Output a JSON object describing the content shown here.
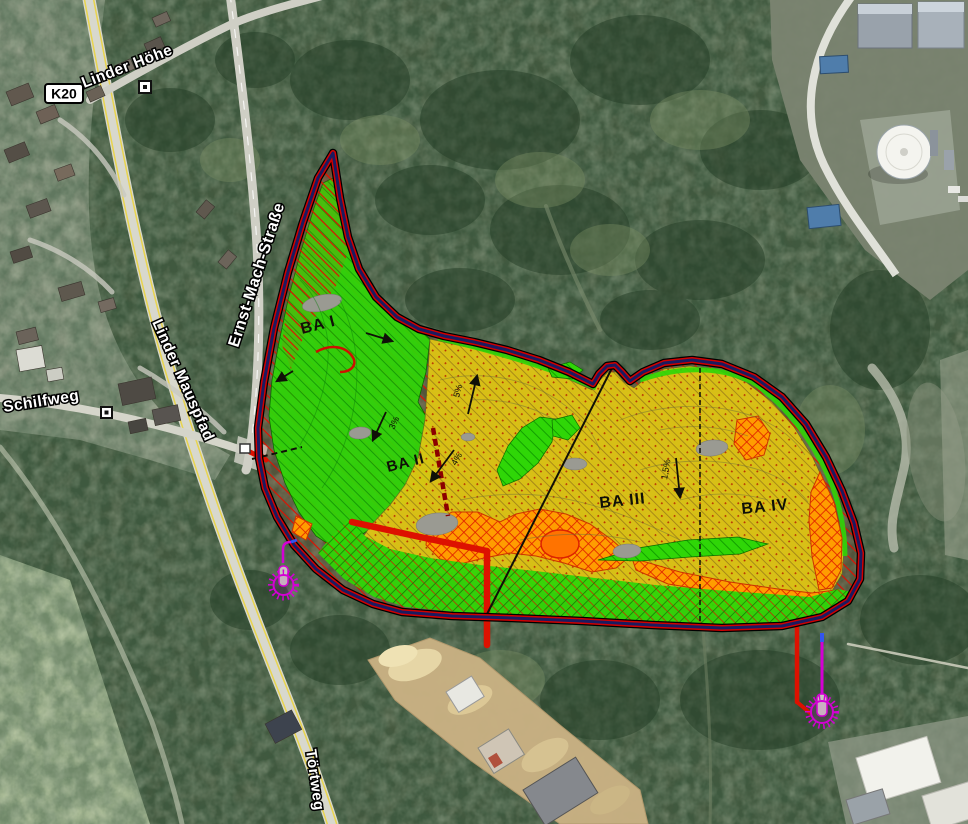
{
  "map": {
    "road_labels": {
      "k20": "K20",
      "linder_hoehe": "Linder Höhe",
      "ernst_mach_strasse": "Ernst-Mach-Straße",
      "linder_mauspfad": "Linder Mauspfad",
      "schilfweg": "Schilfweg",
      "toertweg": "Törtweg"
    },
    "zone_labels": {
      "ba_i": "BA I",
      "ba_ii": "BA II",
      "ba_iii": "BA III",
      "ba_iv": "BA IV"
    },
    "slope_labels": {
      "s1": "5%",
      "s2": "4%",
      "s3": "3%",
      "s4": "1,5%"
    },
    "colors": {
      "zone_green": "#2fd607",
      "zone_yellow": "#dfc513",
      "zone_orange": "#ff9d00",
      "hatch_red": "#e01000",
      "boundary_navy": "#1b1b60",
      "boundary_red": "#d00000",
      "site_road_red": "#dd1100",
      "well_magenta": "#d400d4",
      "pond_gray": "#9a9a92"
    },
    "symbols": {
      "well_west": "gas-well-marker",
      "well_southeast": "gas-well-marker",
      "landmark_square": "map-landmark-symbol"
    }
  }
}
